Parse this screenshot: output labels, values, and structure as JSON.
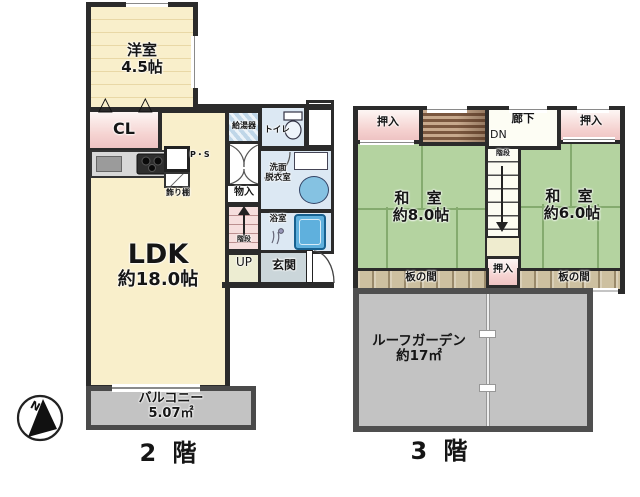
{
  "floor2": {
    "label": "2 階",
    "fold_door_symbol": "△",
    "rooms": {
      "youshitsu_name": "洋室",
      "youshitsu_size": "4.5帖",
      "cl": "CL",
      "ldk_name": "LDK",
      "ldk_size": "約18.0帖",
      "kyutouki": "給湯器",
      "toilet": "トイレ",
      "senmen_line1": "洗面",
      "senmen_line2": "脱衣室",
      "bath": "浴室",
      "mono_ire": "物入",
      "kaidan": "階段",
      "up": "UP",
      "genkan": "玄関",
      "ps": "P・S",
      "kazaridana": "飾り棚",
      "balcony_name": "バルコニー",
      "balcony_size": "5.07㎡"
    }
  },
  "floor3": {
    "label": "3 階",
    "rooms": {
      "oshiire_left": "押入",
      "rouka": "廊下",
      "dn": "DN",
      "oshiire_right": "押入",
      "washitsu8_name": "和 室",
      "washitsu8_size": "約8.0帖",
      "washitsu6_name": "和 室",
      "washitsu6_size": "約6.0帖",
      "kaidan": "階段",
      "oshiire_center": "押入",
      "itanoma_left": "板の間",
      "itanoma_right": "板の間",
      "roof_garden_name": "ルーフガーデン",
      "roof_garden_size": "約17㎡"
    }
  },
  "compass": {
    "north_label": "N"
  },
  "colors": {
    "wall": "#2b2b2b",
    "floor_cream": "#f9efcb",
    "tatami_green": "#b4d3a0",
    "closet_pink": "#f3cdcb",
    "water_blue": "#dce8f3",
    "wood_tan": "#cdc0a0",
    "outdoor_gray": "#c3c3c3"
  }
}
